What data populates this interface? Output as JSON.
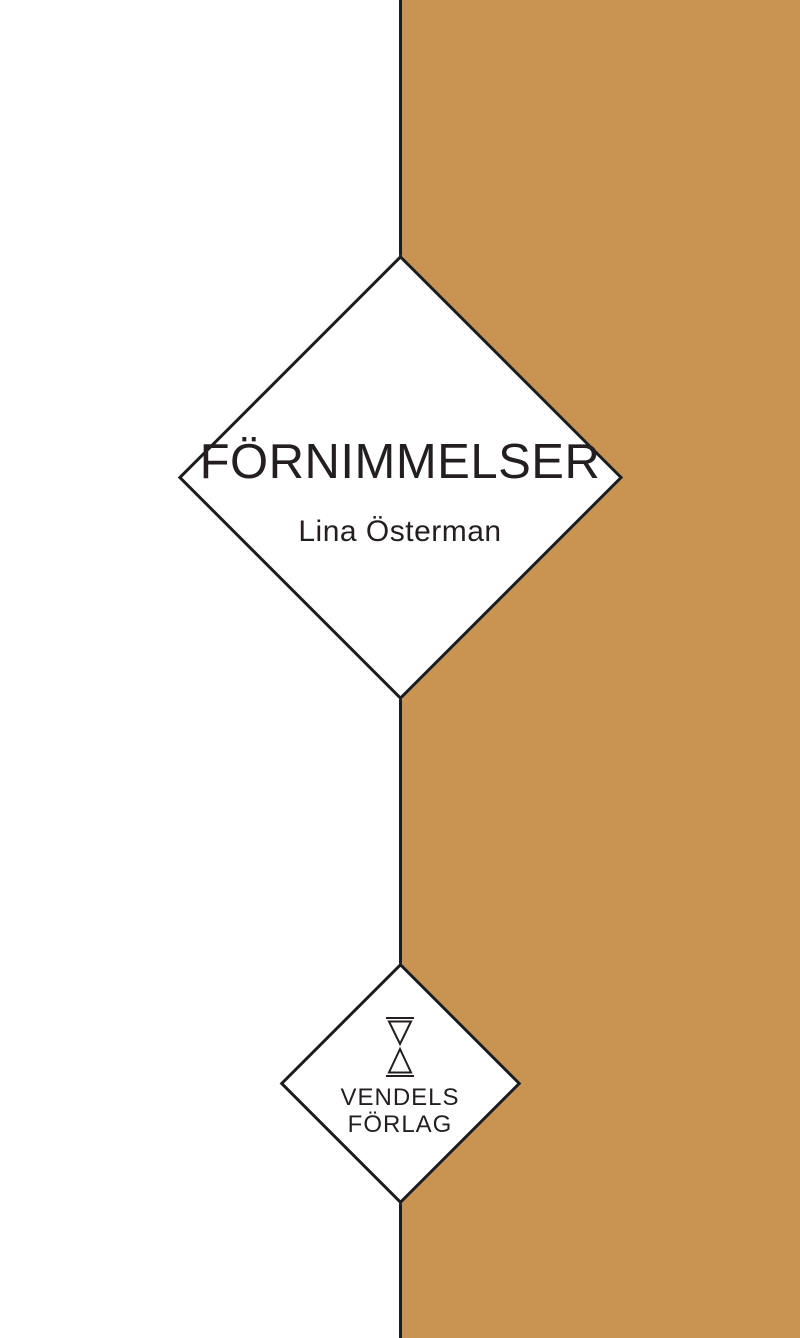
{
  "cover": {
    "title": "FÖRNIMMELSER",
    "author": "Lina Österman",
    "publisher": {
      "line1": "VENDELS",
      "line2": "FÖRLAG",
      "logo_icon": "hourglass-icon"
    },
    "colors": {
      "tan": "#c99451",
      "ink": "#231f20",
      "line": "#1c1c1c",
      "background": "#ffffff"
    }
  }
}
